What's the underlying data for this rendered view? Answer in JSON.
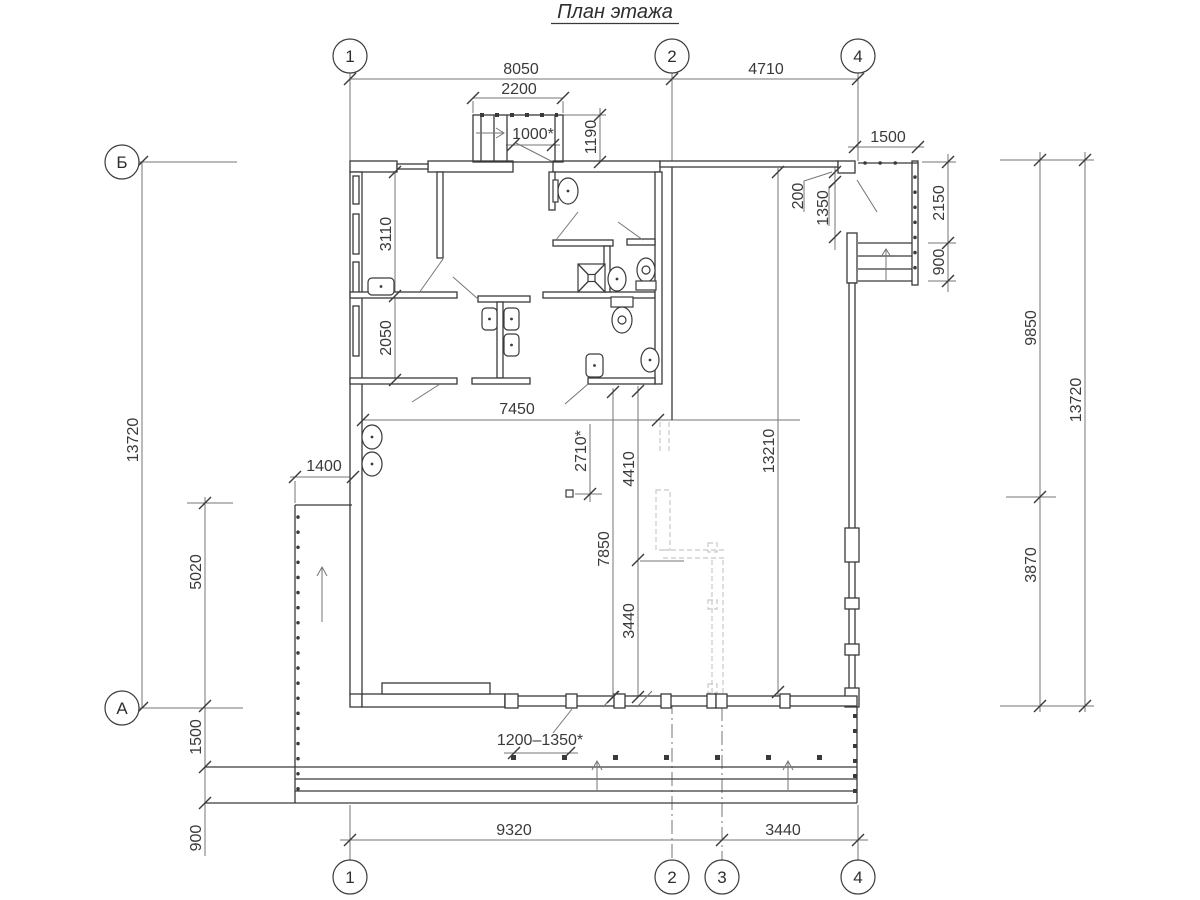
{
  "title": "План этажа",
  "axes": {
    "top": [
      "1",
      "2",
      "4"
    ],
    "bottom": [
      "1",
      "2",
      "3",
      "4"
    ],
    "left": [
      "Б",
      "А"
    ]
  },
  "dims": {
    "w8050": "8050",
    "w2200": "2200",
    "w4710": "4710",
    "door1000": "1000*",
    "h1190": "1190",
    "porch1500": "1500",
    "p200": "200",
    "p1350": "1350",
    "p2150": "2150",
    "p900": "900",
    "r3110": "3110",
    "r2050": "2050",
    "hall7450": "7450",
    "v2710": "2710*",
    "v4410": "4410",
    "v13210": "13210",
    "right9850": "9850",
    "right13720": "13720",
    "right3870": "3870",
    "left13720": "13720",
    "ramp1400": "1400",
    "ramp5020": "5020",
    "v7850": "7850",
    "v3440": "3440",
    "terr1500": "1500",
    "terr900": "900",
    "range1200": "1200–1350*",
    "bot9320": "9320",
    "bot3440": "3440"
  },
  "colors": {
    "line": "#3a3a3a",
    "dim": "#757575",
    "hidden": "#c7c7c7",
    "background": "#ffffff"
  }
}
